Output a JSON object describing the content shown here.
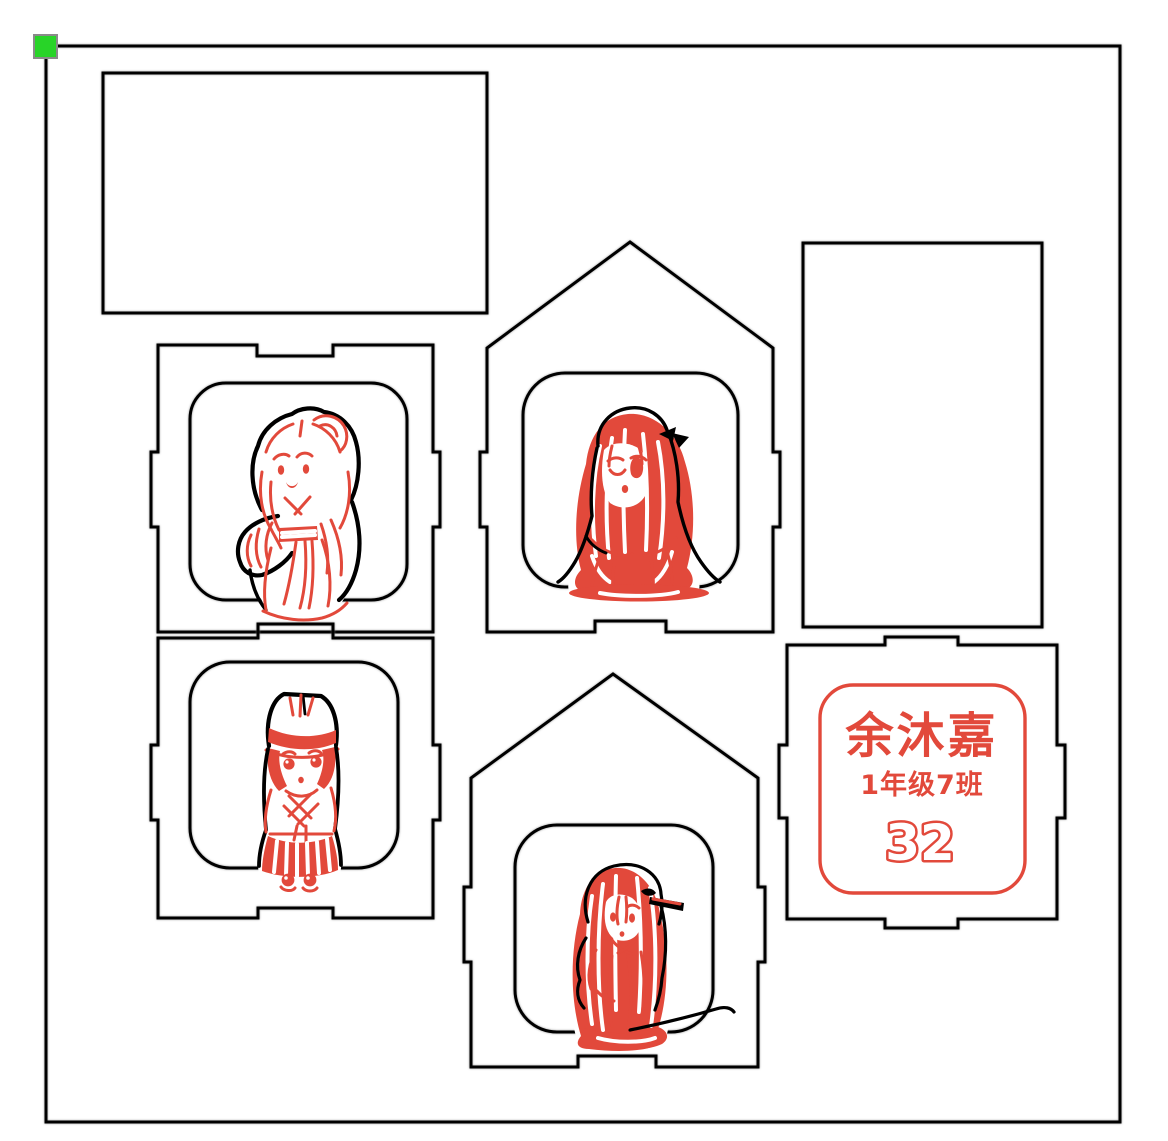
{
  "colors": {
    "canvas_bg": "#ffffff",
    "cut_stroke": "#000000",
    "engrave_red": "#e2493b",
    "handle_green": "#28d428",
    "handle_border": "#8a8a8a"
  },
  "nametag": {
    "name": "余沐嘉",
    "class_label": "1年级7班",
    "number": "32"
  }
}
